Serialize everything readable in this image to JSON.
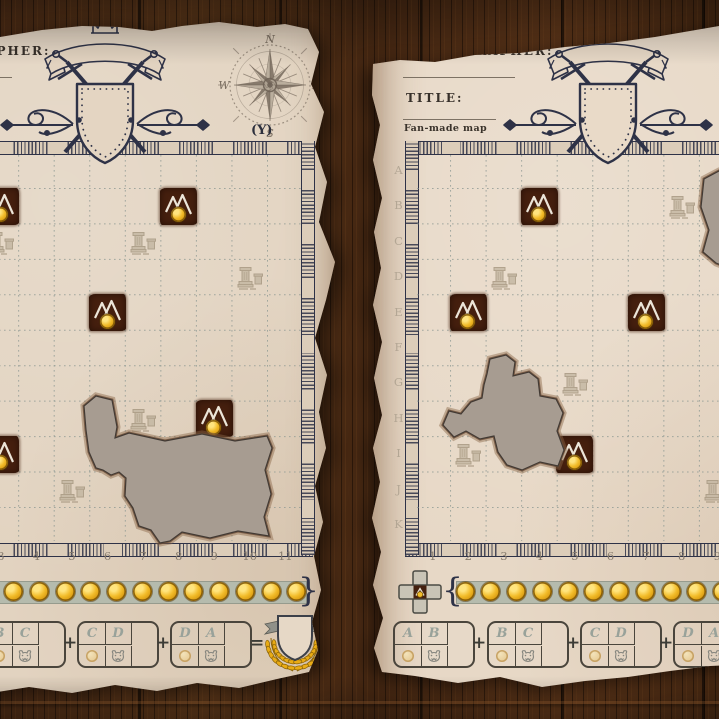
{
  "sheets": [
    {
      "name": "left sheet",
      "header": {
        "cartographer_label": "CARTOGRAPHER:",
        "cartographer_value": "",
        "title_label": "TITLE:",
        "title_value": "",
        "subtitle": "Fan-made map"
      },
      "axis_label": "(Y)",
      "compass": {
        "n": "N",
        "e": "E",
        "s": "S",
        "w": "W"
      },
      "grid": {
        "row_labels": [
          "A",
          "B",
          "C",
          "D",
          "E",
          "F",
          "G",
          "H",
          "I",
          "J",
          "K"
        ],
        "col_labels": [
          "1",
          "2",
          "3",
          "4",
          "5",
          "6",
          "7",
          "8",
          "9",
          "10",
          "11"
        ]
      },
      "mountains": [
        {
          "row": "B",
          "col": 3
        },
        {
          "row": "B",
          "col": 8
        },
        {
          "row": "E",
          "col": 6
        },
        {
          "row": "H",
          "col": 9
        },
        {
          "row": "I",
          "col": 3
        }
      ],
      "ruins": [
        {
          "row": "C",
          "col": 3
        },
        {
          "row": "C",
          "col": 7
        },
        {
          "row": "D",
          "col": 10
        },
        {
          "row": "H",
          "col": 7
        },
        {
          "row": "J",
          "col": 5
        }
      ],
      "holes": [
        "M219,430 L217,406 L229,396 L245,400 L250,427 L248,438 L262,433 L298,441 L335,434 L368,441 L400,436 L405,448 L398,470 L404,494 L397,517 L402,536 L371,531 L343,538 L315,532 L303,541 L293,543 L284,530 L272,526 L266,508 L258,496 L259,478 L252,472 L244,475 L236,470 L229,468 L222,452 Z"
      ],
      "coin_track": {
        "coins": 14,
        "open_brace": "{",
        "close_brace": "}"
      },
      "scoring": {
        "groups": [
          {
            "first": "A",
            "second": "B"
          },
          {
            "first": "B",
            "second": "C"
          },
          {
            "first": "C",
            "second": "D"
          },
          {
            "first": "D",
            "second": "A"
          }
        ],
        "plus": "+",
        "equals": "="
      }
    },
    {
      "name": "right sheet",
      "header": {
        "cartographer_label": "CARTOGRAPHER:",
        "cartographer_value": "",
        "title_label": "TITLE:",
        "title_value": "",
        "subtitle": "Fan-made map"
      },
      "axis_label": "(Y)",
      "compass": {
        "n": "N",
        "e": "E",
        "s": "S",
        "w": "W"
      },
      "grid": {
        "row_labels": [
          "A",
          "B",
          "C",
          "D",
          "E",
          "F",
          "G",
          "H",
          "I",
          "J",
          "K"
        ],
        "col_labels": [
          "1",
          "2",
          "3",
          "4",
          "5",
          "6",
          "7",
          "8",
          "9",
          "10",
          "11"
        ]
      },
      "mountains": [
        {
          "row": "B",
          "col": 4
        },
        {
          "row": "E",
          "col": 2
        },
        {
          "row": "E",
          "col": 7
        },
        {
          "row": "I",
          "col": 5
        }
      ],
      "ruins": [
        {
          "row": "B",
          "col": 8
        },
        {
          "row": "D",
          "col": 3
        },
        {
          "row": "G",
          "col": 5
        },
        {
          "row": "I",
          "col": 2
        },
        {
          "row": "J",
          "col": 9
        }
      ],
      "holes": [
        "M117,374 L120,359 L136,355 L145,362 L143,376 L159,372 L168,379 L170,396 L186,399 L193,413 L187,431 L194,450 L188,466 L170,462 L152,470 L137,465 L128,452 L124,436 L110,439 L96,431 L84,437 L73,425 L79,411 L91,414 L101,402 L112,398 L114,385 Z",
        "M334,179 L349,171 L364,174 L364,270 L346,263 L333,252 L339,230 L331,207 Z"
      ],
      "coin_track": {
        "coins": 14,
        "open_brace": "{",
        "close_brace": "}"
      },
      "scoring": {
        "groups": [
          {
            "first": "A",
            "second": "B"
          },
          {
            "first": "B",
            "second": "C"
          },
          {
            "first": "C",
            "second": "D"
          },
          {
            "first": "D",
            "second": "A"
          }
        ],
        "plus": "+",
        "equals": "="
      }
    }
  ]
}
